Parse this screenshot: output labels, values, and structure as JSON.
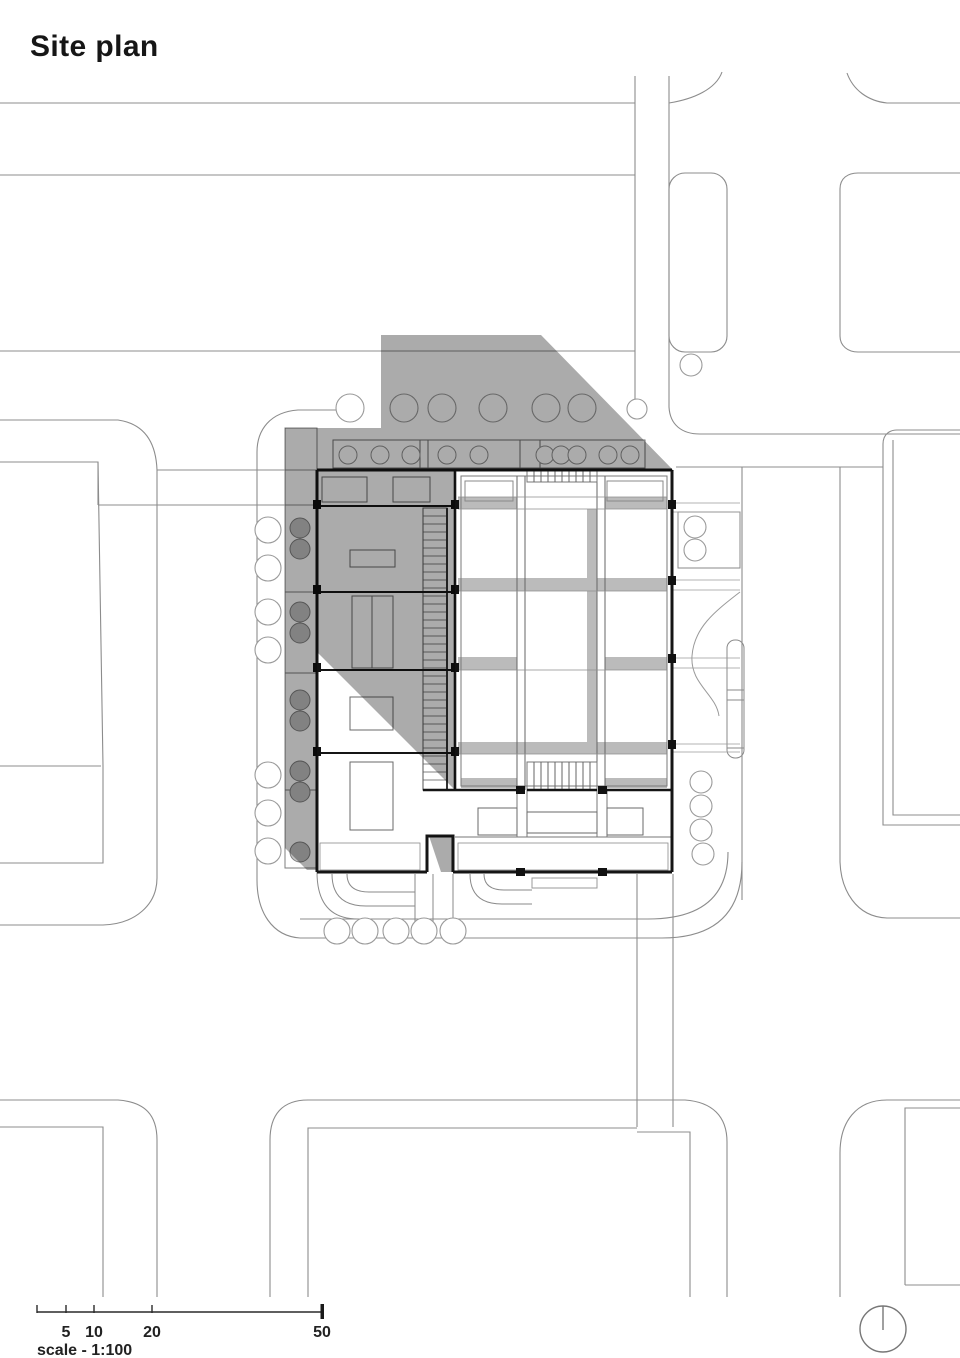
{
  "title": "Site plan",
  "scale_bar": {
    "ticks": [
      "5",
      "10",
      "20",
      "50"
    ],
    "label": "scale - 1:100"
  },
  "symbols": {
    "north_arrow": "north-arrow-circle-with-radius-line"
  },
  "colors": {
    "background": "#ffffff",
    "context_line": "#8c8c8c",
    "building_wall": "#151515",
    "interior_line": "#666666",
    "shadow_overlay": "#ababab",
    "courtyard_band": "#bbbbbb",
    "tree_outline": "#9a9a9a"
  }
}
